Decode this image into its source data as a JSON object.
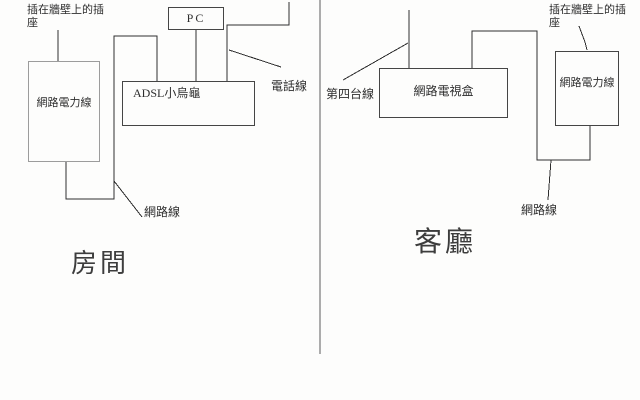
{
  "canvas": {
    "background_color": "#fdfdfc",
    "wire_color": "#2f2f2f",
    "gray_box_border_color": "#9c9c9c",
    "divider_color": "#5c5c5c"
  },
  "room_section": {
    "title": "房間",
    "boxes": {
      "powerline_adapter": "網路電力線",
      "adsl_modem": "ADSL小烏龜",
      "pc": "PC"
    },
    "labels": {
      "wall_socket": "插在牆壁上的插座",
      "phone_line": "電話線",
      "network_line": "網路線"
    }
  },
  "living_room_section": {
    "title": "客廳",
    "boxes": {
      "tv_box": "網路電視盒",
      "powerline_adapter": "網路電力線"
    },
    "labels": {
      "cable_tv_line": "第四台線",
      "network_line": "網路線",
      "wall_socket": "插在牆壁上的插座"
    }
  }
}
